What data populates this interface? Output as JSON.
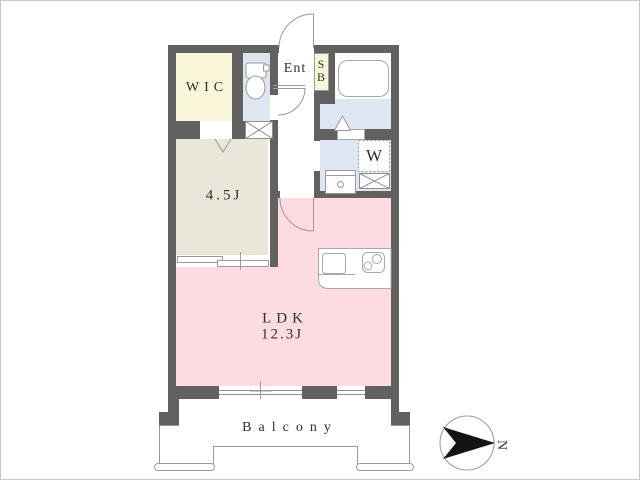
{
  "floor_plan": {
    "rooms": {
      "wic": {
        "label": "WIC"
      },
      "entrance": {
        "label": "Ent"
      },
      "shoe_box": {
        "line1": "S",
        "line2": "B"
      },
      "laundry": {
        "washer_label": "W"
      },
      "western_room": {
        "label": "4.5J"
      },
      "ldk": {
        "label": "LDK",
        "size": "12.3J"
      },
      "balcony": {
        "label": "Balcony"
      }
    },
    "compass": {
      "north_label": "N"
    },
    "colors": {
      "wall": "#616161",
      "wic_floor": "#f8f5d8",
      "shoe_box_floor": "#f8f5d8",
      "wet_area_floor": "#dee6f2",
      "western_room_floor": "#eae6da",
      "ldk_floor": "#fcdce0",
      "outline": "#9a9a9a"
    }
  }
}
